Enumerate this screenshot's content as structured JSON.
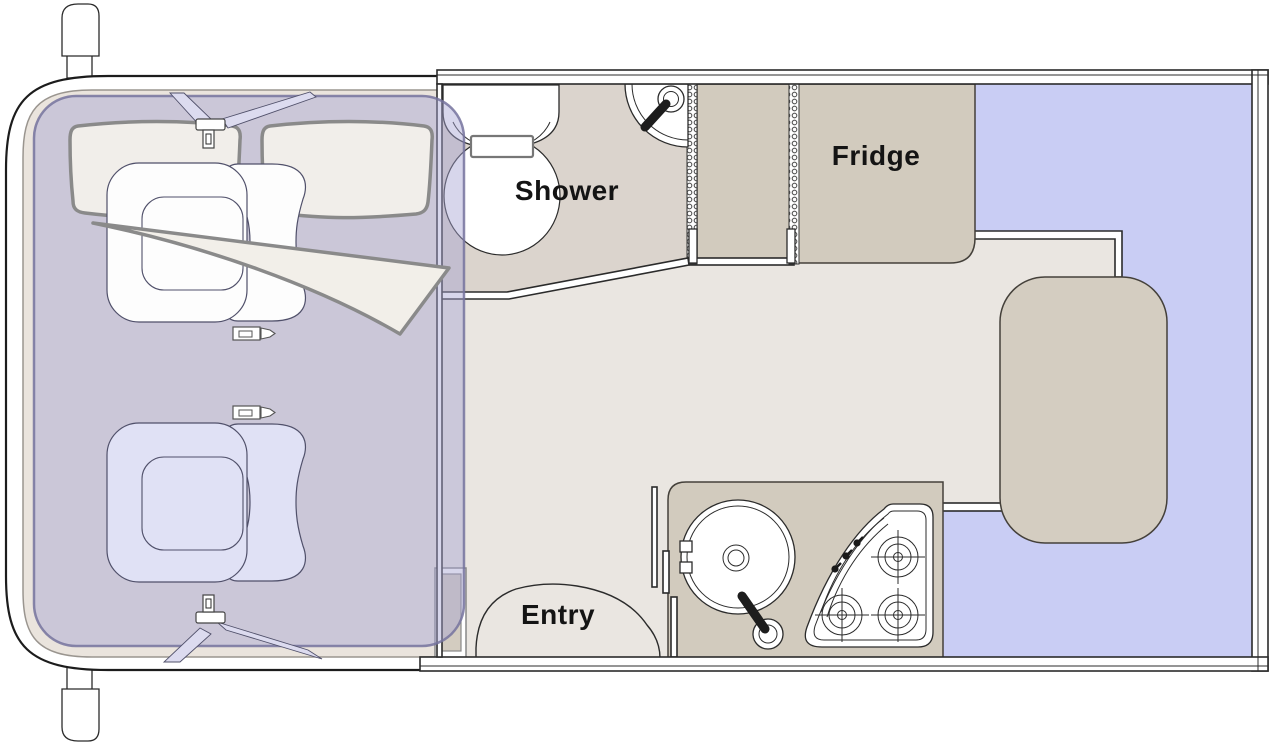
{
  "diagram": {
    "type": "motorhome-floor-plan",
    "labels": {
      "shower": "Shower",
      "fridge": "Fridge",
      "entry": "Entry"
    },
    "areas": [
      {
        "name": "cab",
        "description": "truck cab with two seats and over-cab bed overlay"
      },
      {
        "name": "bathroom",
        "description": "shower room with toilet, vanity basin and corner sink"
      },
      {
        "name": "wardrobe",
        "description": "cabinet between sliding partitions"
      },
      {
        "name": "fridge",
        "description": "refrigerator cabinet"
      },
      {
        "name": "kitchen",
        "description": "kitchen block with round sink and 3-burner stove"
      },
      {
        "name": "entry",
        "description": "entry door swing arc"
      },
      {
        "name": "dinette",
        "description": "rear U-shaped dinette bed with table"
      }
    ],
    "fixtures": [
      "side-mirror",
      "cab-seat",
      "seatbelt-buckle",
      "gear-lever",
      "over-cab-bed-mattress",
      "swivel-arrow",
      "vanity-basin",
      "toilet",
      "corner-basin",
      "faucet",
      "kitchen-sink",
      "stove-burner",
      "stove-knob",
      "dinette-table",
      "entry-arc"
    ]
  },
  "palette": {
    "wall": "#ffffff",
    "floor": "#EAE6E1",
    "bathroomFloor": "#DBD4CD",
    "cabinet": "#D2CBBE",
    "table": "#D4CDC1",
    "bed": "#C9CDF4",
    "cabFloor": "#EAE4DD",
    "overlay": "rgba(167,164,211,0.45)",
    "overlayStroke": "rgba(118,115,158,0.85)",
    "mattress": "#F1EEEA",
    "swoosh": "#F2EFE9",
    "strap": "#DCDBEF",
    "seatPassenger": "#FDFDFD",
    "seatDriver": "#E0E1F5",
    "lineDark": "#2B2B2B",
    "lineMid": "#44403A",
    "lineGray": "#8A8A8A",
    "labelColor": "#141414"
  }
}
